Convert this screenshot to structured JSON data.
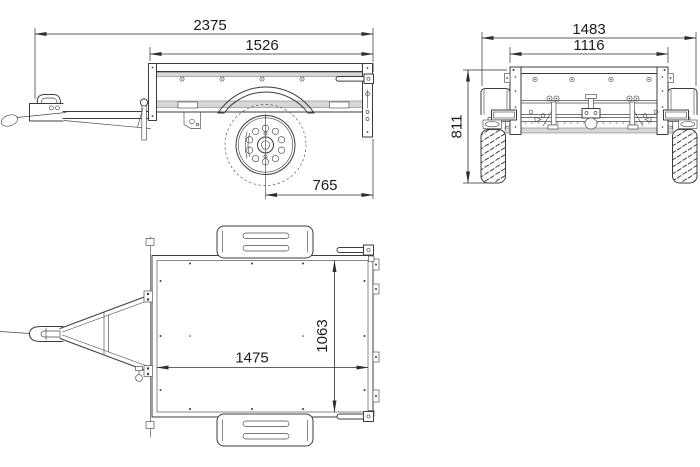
{
  "dims": {
    "side": {
      "overall_length": "2375",
      "box_top_length": "1526",
      "axle_to_rear": "765"
    },
    "rear": {
      "overall_width": "1483",
      "box_width": "1116",
      "overall_height": "811"
    },
    "top": {
      "bed_inner_length": "1475",
      "bed_inner_width": "1063"
    }
  },
  "colors": {
    "line": "#3c3c3c",
    "dimension": "#2e2e2e",
    "text": "#1b1b1b",
    "light_fill": "#d7d7d7",
    "background": "#ffffff"
  }
}
